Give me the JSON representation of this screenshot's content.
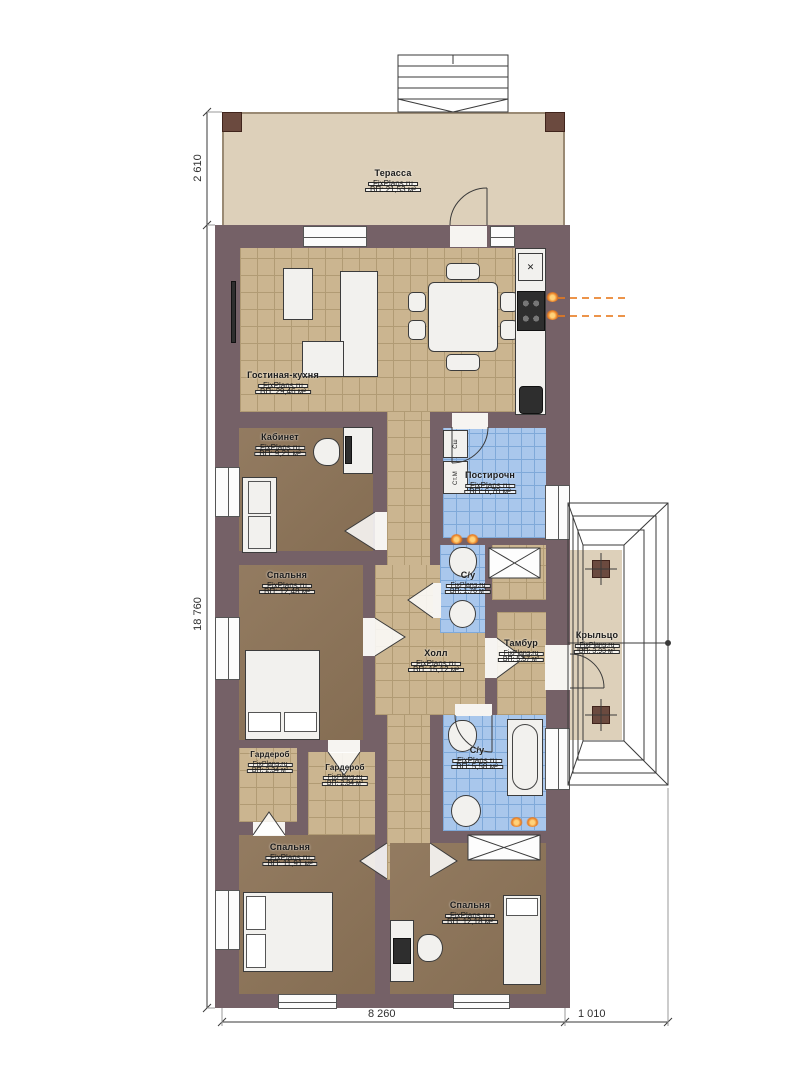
{
  "plan": {
    "brand_label": "FixPlans.ru",
    "rooms": [
      {
        "name": "Терасса",
        "area": "ВП: 21,53 м²"
      },
      {
        "name": "Гостиная-кухня",
        "area": "ВП: 29,46 м²"
      },
      {
        "name": "Кабинет",
        "area": "ВП: 9,21 м²"
      },
      {
        "name": "Постирочн",
        "area": "ВП: 6,70 м²"
      },
      {
        "name": "Спальня",
        "area": "ВП: 12,48 м²"
      },
      {
        "name": "С/у",
        "area": "ВП: 1,76 м²"
      },
      {
        "name": "Холл",
        "area": "ВП: 15,12 м²"
      },
      {
        "name": "Тамбур",
        "area": "ВП: 5,57 м²"
      },
      {
        "name": "Крыльцо",
        "area": "ВП: 3,93 м²"
      },
      {
        "name": "Гардероб",
        "area": "ВП: 2,34 м²"
      },
      {
        "name": "Гардероб",
        "area": "ВП: 2,84 м²"
      },
      {
        "name": "С/у",
        "area": "ВП: 5,58 м²"
      },
      {
        "name": "Спальня",
        "area": "ВП: 11,91 м²"
      },
      {
        "name": "Спальня",
        "area": "ВП: 12,18 м²"
      }
    ],
    "appliances": {
      "dryer": "Сш",
      "washer": "Ст.М"
    },
    "icons": {
      "vent_symbol": "✕"
    },
    "dimensions": {
      "terrace_height": "2 610",
      "house_height": "18 760",
      "house_width": "8 260",
      "porch_width": "1 010"
    },
    "colors": {
      "wall": "#756167",
      "terrace": "#ddd0ba",
      "tileTan": "#cbb590",
      "tileLine": "#b19b74",
      "floorBrown": "#8d7458",
      "tileBlue": "#a9c7ec",
      "tileBlueLine": "#7fa9d9",
      "furn": "#f2f1ee",
      "flame": "#e87a1e"
    }
  }
}
